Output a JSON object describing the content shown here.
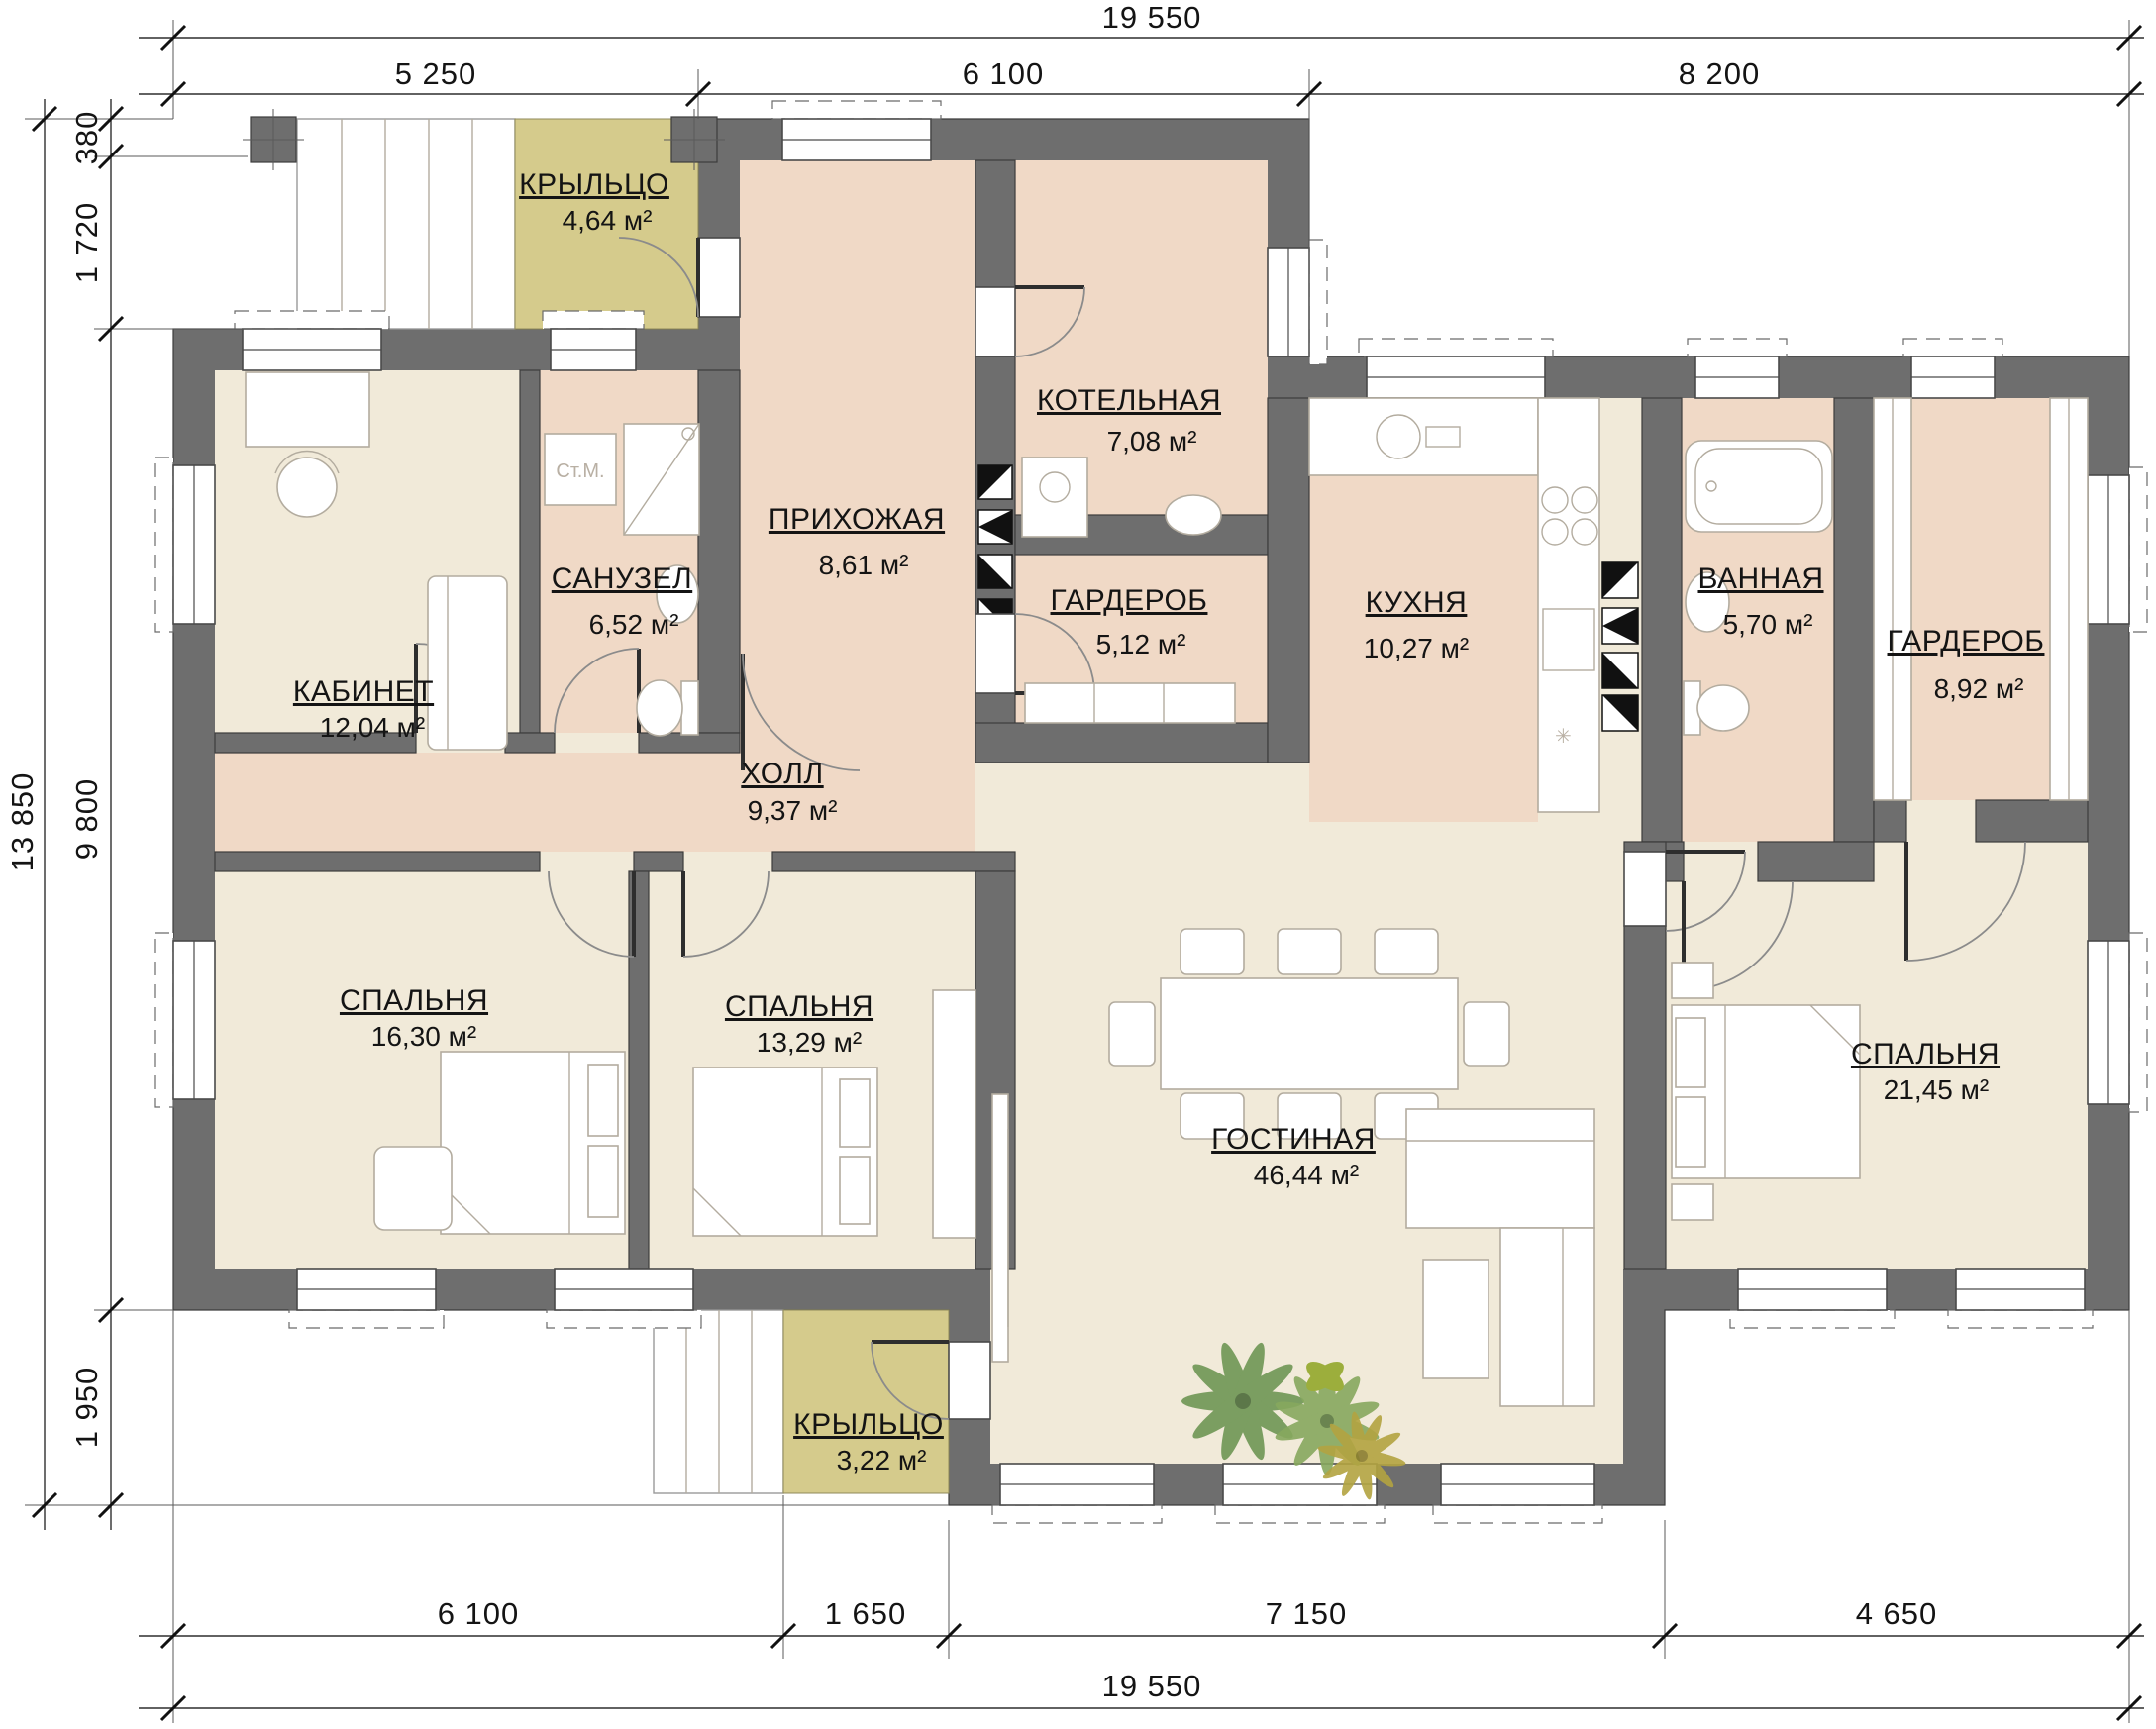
{
  "drawing": {
    "type": "floor-plan",
    "language": "ru"
  },
  "dimensions": {
    "top_total": "19 550",
    "top_segments": [
      "5 250",
      "6 100",
      "8 200"
    ],
    "left_total": "13 850",
    "left_segments": [
      "380",
      "1 720",
      "9 800",
      "1 950"
    ],
    "bottom_segments": [
      "6 100",
      "1 650",
      "7 150",
      "4 650"
    ],
    "bottom_total": "19 550"
  },
  "rooms": [
    {
      "id": "porch-top",
      "name": "КРЫЛЬЦО",
      "area": "4,64 м²"
    },
    {
      "id": "entry",
      "name": "ПРИХОЖАЯ",
      "area": "8,61 м²"
    },
    {
      "id": "boiler",
      "name": "КОТЕЛЬНАЯ",
      "area": "7,08 м²"
    },
    {
      "id": "wc",
      "name": "САНУЗЕЛ",
      "area": "6,52 м²"
    },
    {
      "id": "cabinet",
      "name": "КАБИНЕТ",
      "area": "12,04 м²"
    },
    {
      "id": "wardrobe-1",
      "name": "ГАРДЕРОБ",
      "area": "5,12 м²"
    },
    {
      "id": "kitchen",
      "name": "КУХНЯ",
      "area": "10,27 м²"
    },
    {
      "id": "bath",
      "name": "ВАННАЯ",
      "area": "5,70 м²"
    },
    {
      "id": "wardrobe-2",
      "name": "ГАРДЕРОБ",
      "area": "8,92 м²"
    },
    {
      "id": "hall",
      "name": "ХОЛЛ",
      "area": "9,37 м²"
    },
    {
      "id": "bedroom-1",
      "name": "СПАЛЬНЯ",
      "area": "16,30 м²"
    },
    {
      "id": "bedroom-2",
      "name": "СПАЛЬНЯ",
      "area": "13,29 м²"
    },
    {
      "id": "living",
      "name": "ГОСТИНАЯ",
      "area": "46,44 м²"
    },
    {
      "id": "bedroom-3",
      "name": "СПАЛЬНЯ",
      "area": "21,45 м²"
    },
    {
      "id": "porch-bottom",
      "name": "КРЫЛЬЦО",
      "area": "3,22 м²"
    }
  ],
  "labels": {
    "washing_machine": "Ст.М."
  },
  "colors": {
    "wall": "#6e6e6e",
    "room_warm": "#f0d9c6",
    "room_light": "#f1ead9",
    "porch": "#d5cb8c",
    "text": "#141414"
  }
}
